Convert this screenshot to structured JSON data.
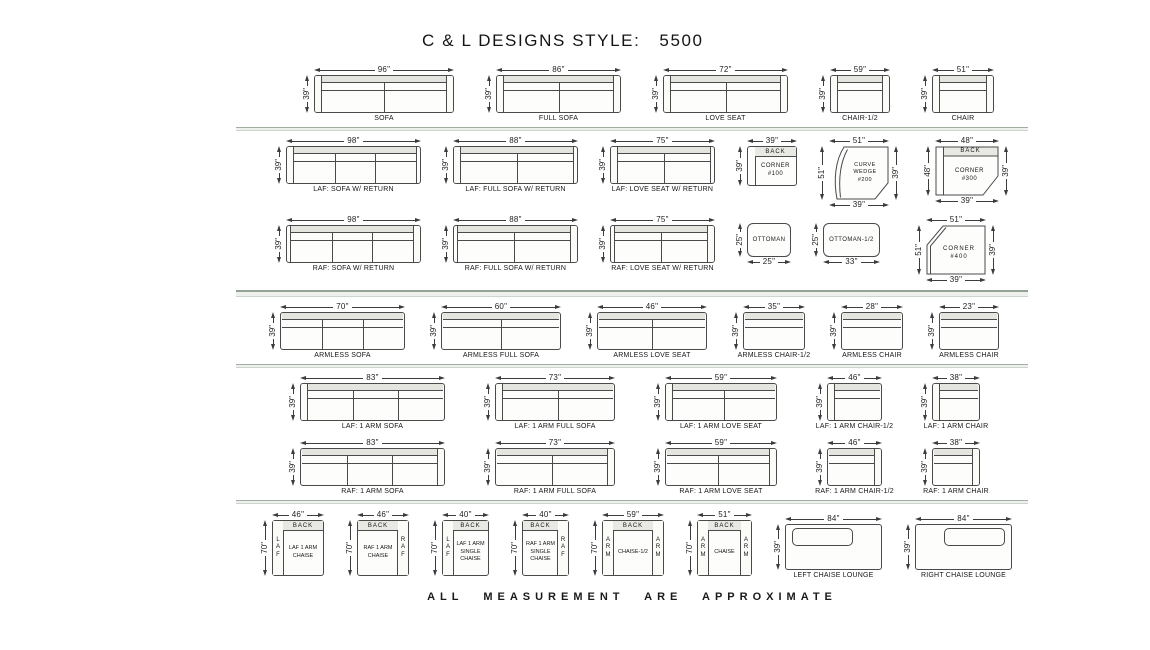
{
  "title": "C & L DESIGNS STYLE:   5500",
  "footer": "ALL MEASUREMENT ARE APPROXIMATE",
  "colors": {
    "line": "#3c3c3c",
    "outline": "#4a4a4a",
    "back_band": "#e5e5e0",
    "separator": "#9fae9f"
  },
  "rows": [
    {
      "name": "standard-pieces",
      "sep": "single",
      "items": [
        {
          "t": "sofa",
          "label": "SOFA",
          "w": "96\"",
          "h": "39\"",
          "arms": "both",
          "c": 2,
          "pw": 140
        },
        {
          "t": "sofa",
          "label": "FULL SOFA",
          "w": "86\"",
          "h": "39\"",
          "arms": "both",
          "c": 2,
          "pw": 125
        },
        {
          "t": "sofa",
          "label": "LOVE SEAT",
          "w": "72\"",
          "h": "39\"",
          "arms": "both",
          "c": 2,
          "pw": 125
        },
        {
          "t": "sofa",
          "label": "CHAIR-1/2",
          "w": "59\"",
          "h": "39\"",
          "arms": "both",
          "c": 1,
          "pw": 60
        },
        {
          "t": "sofa",
          "label": "CHAIR",
          "w": "51\"",
          "h": "39\"",
          "arms": "both",
          "c": 1,
          "pw": 62
        }
      ]
    },
    {
      "name": "laf-return-pieces",
      "sep": null,
      "items": [
        {
          "t": "sofa",
          "label": "LAF: SOFA W/ RETURN",
          "w": "98\"",
          "h": "39\"",
          "arms": "left",
          "ret": "right",
          "c": 3,
          "pw": 135
        },
        {
          "t": "sofa",
          "label": "LAF: FULL SOFA W/ RETURN",
          "w": "88\"",
          "h": "39\"",
          "arms": "left",
          "ret": "right",
          "c": 2,
          "pw": 125
        },
        {
          "t": "sofa",
          "label": "LAF: LOVE SEAT W/ RETURN",
          "w": "75\"",
          "h": "39\"",
          "arms": "left",
          "ret": "right",
          "c": 2,
          "pw": 105
        },
        {
          "t": "c100",
          "w": "39\"",
          "h": "39\"",
          "back": "BACK",
          "inner": [
            "CORNER",
            "#100"
          ],
          "pw": 50,
          "ph": 40
        },
        {
          "t": "wedge",
          "w": "51\"",
          "h": "51\"",
          "r": "39\"",
          "b": "39\"",
          "inner": [
            "CURVE",
            "WEDGE",
            "#200"
          ],
          "pw": 60,
          "ph": 54
        },
        {
          "t": "c300",
          "w": "48\"",
          "h": "48\"",
          "r": "39\"",
          "b": "39\"",
          "back": "BACK",
          "inner": [
            "CORNER",
            "#300"
          ],
          "pw": 64,
          "ph": 50
        }
      ]
    },
    {
      "name": "raf-return-pieces",
      "sep": "double",
      "items": [
        {
          "t": "sofa",
          "label": "RAF: SOFA W/ RETURN",
          "w": "98\"",
          "h": "39\"",
          "arms": "right",
          "ret": "left",
          "c": 3,
          "pw": 135
        },
        {
          "t": "sofa",
          "label": "RAF: FULL SOFA W/ RETURN",
          "w": "88\"",
          "h": "39\"",
          "arms": "right",
          "ret": "left",
          "c": 2,
          "pw": 125
        },
        {
          "t": "sofa",
          "label": "RAF: LOVE SEAT W/ RETURN",
          "w": "75\"",
          "h": "39\"",
          "arms": "right",
          "ret": "left",
          "c": 2,
          "pw": 105
        },
        {
          "t": "ottoman",
          "h": "25\"",
          "b": "25\"",
          "inner": [
            "OTTOMAN"
          ],
          "pw": 44,
          "ph": 34,
          "mt": 8
        },
        {
          "t": "ottoman",
          "h": "25\"",
          "b": "33\"",
          "inner": [
            "OTTOMAN-1/2"
          ],
          "pw": 57,
          "ph": 34,
          "mt": 8
        },
        {
          "t": "c400",
          "w": "51\"",
          "h": "51\"",
          "r": "39\"",
          "b": "39\"",
          "inner": [
            "CORNER",
            "#400"
          ],
          "pw": 60,
          "ph": 50,
          "ml": 14
        }
      ]
    },
    {
      "name": "armless-pieces",
      "sep": "single",
      "items": [
        {
          "t": "sofa",
          "label": "ARMLESS SOFA",
          "w": "70\"",
          "h": "39\"",
          "arms": "none",
          "c": 3,
          "pw": 125
        },
        {
          "t": "sofa",
          "label": "ARMLESS FULL SOFA",
          "w": "60\"",
          "h": "39\"",
          "arms": "none",
          "c": 2,
          "pw": 120
        },
        {
          "t": "sofa",
          "label": "ARMLESS LOVE SEAT",
          "w": "46\"",
          "h": "39\"",
          "arms": "none",
          "c": 2,
          "pw": 110
        },
        {
          "t": "sofa",
          "label": "ARMLESS CHAIR-1/2",
          "w": "35\"",
          "h": "39\"",
          "arms": "none",
          "c": 1,
          "pw": 62
        },
        {
          "t": "sofa",
          "label": "ARMLESS CHAIR",
          "w": "28\"",
          "h": "39\"",
          "arms": "none",
          "c": 1,
          "pw": 62
        },
        {
          "t": "sofa",
          "label": "ARMLESS CHAIR",
          "w": "23\"",
          "h": "39\"",
          "arms": "none",
          "c": 1,
          "pw": 60
        }
      ]
    },
    {
      "name": "laf-one-arm-pieces",
      "sep": null,
      "items": [
        {
          "t": "sofa",
          "label": "LAF: 1 ARM SOFA",
          "w": "83\"",
          "h": "39\"",
          "arms": "left",
          "c": 3,
          "pw": 145
        },
        {
          "t": "sofa",
          "label": "LAF: 1 ARM FULL SOFA",
          "w": "73\"",
          "h": "39\"",
          "arms": "left",
          "c": 2,
          "pw": 120
        },
        {
          "t": "sofa",
          "label": "LAF: 1 ARM LOVE SEAT",
          "w": "59\"",
          "h": "39\"",
          "arms": "left",
          "c": 2,
          "pw": 112
        },
        {
          "t": "sofa",
          "label": "LAF: 1 ARM CHAIR-1/2",
          "w": "46\"",
          "h": "39\"",
          "arms": "left",
          "c": 1,
          "pw": 55
        },
        {
          "t": "sofa",
          "label": "LAF: 1 ARM CHAIR",
          "w": "38\"",
          "h": "39\"",
          "arms": "left",
          "c": 1,
          "pw": 48
        }
      ]
    },
    {
      "name": "raf-one-arm-pieces",
      "sep": "single",
      "items": [
        {
          "t": "sofa",
          "label": "RAF: 1 ARM SOFA",
          "w": "83\"",
          "h": "39\"",
          "arms": "right",
          "c": 3,
          "pw": 145
        },
        {
          "t": "sofa",
          "label": "RAF: 1 ARM FULL SOFA",
          "w": "73\"",
          "h": "39\"",
          "arms": "right",
          "c": 2,
          "pw": 120
        },
        {
          "t": "sofa",
          "label": "RAF: 1 ARM LOVE SEAT",
          "w": "59\"",
          "h": "39\"",
          "arms": "right",
          "c": 2,
          "pw": 112
        },
        {
          "t": "sofa",
          "label": "RAF: 1 ARM CHAIR-1/2",
          "w": "46\"",
          "h": "39\"",
          "arms": "right",
          "c": 1,
          "pw": 55
        },
        {
          "t": "sofa",
          "label": "RAF: 1 ARM CHAIR",
          "w": "38\"",
          "h": "39\"",
          "arms": "right",
          "c": 1,
          "pw": 48
        }
      ]
    },
    {
      "name": "chaise-pieces",
      "sep": null,
      "items": [
        {
          "t": "chaise",
          "w": "46\"",
          "h": "70\"",
          "back": "BACK",
          "side": "LAF",
          "sp": "left",
          "inner": [
            "LAF 1 ARM",
            "CHAISE"
          ],
          "pw": 52,
          "ph": 56
        },
        {
          "t": "chaise",
          "w": "46\"",
          "h": "70\"",
          "back": "BACK",
          "side": "RAF",
          "sp": "right",
          "inner": [
            "RAF 1 ARM",
            "CHAISE"
          ],
          "pw": 52,
          "ph": 56
        },
        {
          "t": "chaise",
          "w": "40\"",
          "h": "70\"",
          "back": "BACK",
          "side": "LAF",
          "sp": "left",
          "inner": [
            "LAF 1 ARM",
            "SINGLE",
            "CHAISE"
          ],
          "pw": 47,
          "ph": 56
        },
        {
          "t": "chaise",
          "w": "40\"",
          "h": "70\"",
          "back": "BACK",
          "side": "RAF",
          "sp": "right",
          "inner": [
            "RAF 1 ARM",
            "SINGLE",
            "CHAISE"
          ],
          "pw": 47,
          "ph": 56
        },
        {
          "t": "chaise",
          "w": "59\"",
          "h": "70\"",
          "back": "BACK",
          "side": "ARM",
          "sp": "both",
          "inner": [
            "CHAISE-1/2"
          ],
          "pw": 62,
          "ph": 56
        },
        {
          "t": "chaise",
          "w": "51\"",
          "h": "70\"",
          "back": "BACK",
          "side": "ARM",
          "sp": "both",
          "inner": [
            "CHAISE"
          ],
          "pw": 55,
          "ph": 56
        },
        {
          "t": "lounge",
          "label": "LEFT CHAISE LOUNGE",
          "w": "84\"",
          "h": "39\"",
          "cushion": "left",
          "pw": 97,
          "ph": 46,
          "mt": 4
        },
        {
          "t": "lounge",
          "label": "RIGHT CHAISE LOUNGE",
          "w": "84\"",
          "h": "39\"",
          "cushion": "right",
          "pw": 97,
          "ph": 46,
          "mt": 4
        }
      ]
    }
  ]
}
